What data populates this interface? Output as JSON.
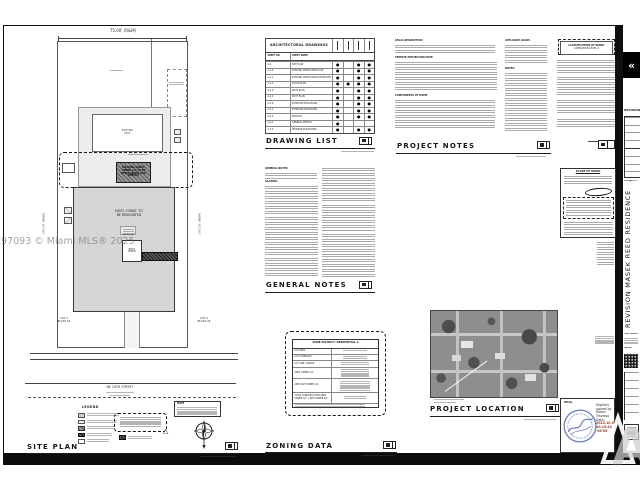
{
  "watermark": "297093 © Miami MLS® 2025",
  "nav": {
    "prev_arrow": "«"
  },
  "colors": {
    "seal_stamp_blue": "#4a66b0",
    "signature_date_red": "#9c3a28",
    "sheet_line": "#222222"
  },
  "site_plan": {
    "title": "SITE PLAN",
    "dim_top": "75.00' (R&M)",
    "dim_left": "147.50' (R&M)",
    "dim_right": "147.50' (R&M)",
    "street": "NE 18TH STREET",
    "pool_lines": [
      "EXISTING",
      "POOL"
    ],
    "demo_lines": [
      "EXISTING CONST.",
      "UNDER A/C TO BE",
      "DEMOLISHED AND",
      "REBUILT"
    ],
    "renov_lines": [
      "EXIST. CONST. TO",
      "BE RENOVATED"
    ],
    "porch_lines": [
      "EXIST.",
      "PORCH"
    ],
    "lot_left": [
      "LOT 2",
      "BLOCK 24"
    ],
    "lot_right": [
      "LOT 4",
      "BLOCK 24"
    ],
    "legend_title": "LEGEND",
    "note_title": "NOTE",
    "warning_glyph": "△"
  },
  "drawing_list": {
    "heading": "DRAWING LIST",
    "table_title": "ARCHITECTURAL DRAWINGS",
    "col_no": "SHEET NO",
    "col_name": "SHEET NAME",
    "rows": [
      {
        "no": "A-0",
        "name": "SITE PLAN",
        "d1": "●",
        "d2": "",
        "d3": "●",
        "d4": "●"
      },
      {
        "no": "A-1.0",
        "name": "EXISTING DEMOLITION PLAN",
        "d1": "●",
        "d2": "",
        "d3": "●",
        "d4": "●"
      },
      {
        "no": "A-1.1",
        "name": "EXISTING DEMOLITION ELEVATIONS",
        "d1": "●",
        "d2": "",
        "d3": "●",
        "d4": "●"
      },
      {
        "no": "A-1.2",
        "name": "FLOOR PLAN",
        "d1": "●",
        "d2": "●",
        "d3": "●",
        "d4": "●"
      },
      {
        "no": "A-2.0",
        "name": "ROOF PLAN",
        "d1": "●",
        "d2": "",
        "d3": "●",
        "d4": "●"
      },
      {
        "no": "A-2.1",
        "name": "ROOF PLAN",
        "d1": "●",
        "d2": "",
        "d3": "●",
        "d4": "●"
      },
      {
        "no": "A-3.0",
        "name": "EXTERIOR ELEVATIONS",
        "d1": "●",
        "d2": "",
        "d3": "●",
        "d4": "●"
      },
      {
        "no": "A-3.1",
        "name": "EXTERIOR ELEVATIONS",
        "d1": "●",
        "d2": "",
        "d3": "●",
        "d4": "●"
      },
      {
        "no": "A-4.0",
        "name": "SECTION",
        "d1": "●",
        "d2": "",
        "d3": "●",
        "d4": "●"
      },
      {
        "no": "A-4.1",
        "name": "GENERAL DETAILS",
        "d1": "●",
        "d2": "",
        "d3": "",
        "d4": ""
      },
      {
        "no": "A-5.0",
        "name": "INTERIOR ELEVATIONS",
        "d1": "●",
        "d2": "",
        "d3": "●",
        "d4": "●"
      }
    ]
  },
  "general_notes": {
    "heading": "GENERAL NOTES",
    "intro": "GENERAL NOTES:",
    "sub": "GLAZING:"
  },
  "project_notes": {
    "heading": "PROJECT NOTES",
    "h_legal": "LEGAL DESCRIPTION",
    "h_termite": "TERMITE PROTECTION NOTE",
    "h_components": "COMPONENTS OF HOME",
    "h_appliance": "APPLIANCE LOADS",
    "h_notes": "NOTES:"
  },
  "classification": {
    "line1": "CLASSIFICATION OF WORK:",
    "line2": "ALTERATION LEVEL 2"
  },
  "scope": {
    "heading": "SCOPE OF WORK"
  },
  "zoning": {
    "heading": "ZONING DATA",
    "header": "ZONE DISTRICT: RESIDENTIAL-2",
    "row_labels": [
      "LOT AREA",
      "LOT COVERAGE",
      "LOT SIZE / GRADE",
      "AREA UNDER A/C",
      "AREA NOT UNDER A/C",
      "TOTAL CONSTRUCTION AREA UNDER A/C + NOT UNDER A/C"
    ]
  },
  "location": {
    "heading": "PROJECT LOCATION"
  },
  "titleblock": {
    "revision": "REVISION",
    "project": "PROJECT:",
    "vertical": "REVISION MASEK REED RESIDENCE",
    "copyright": "COPYRIGHT",
    "seal": "SEAL"
  },
  "seal": {
    "label": "SEAL",
    "sig": [
      "Digitally",
      "signed by",
      "Ruben",
      "Travieso",
      "Date:",
      "2023.10.03",
      "10:15:44",
      "-04'00'"
    ]
  }
}
